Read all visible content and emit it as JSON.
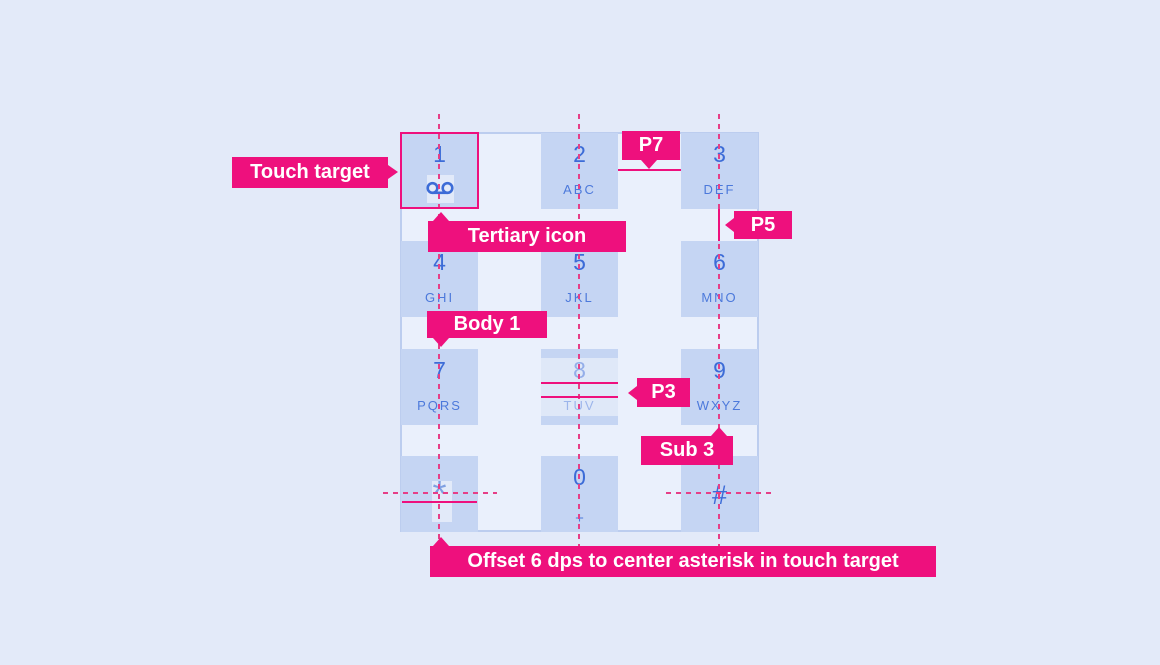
{
  "colors": {
    "page_background": "#E3EAF9",
    "panel_background": "#EAF0FC",
    "panel_border": "#BCCDEF",
    "key_fill": "#C5D5F3",
    "digit_blue": "#3C6CD7",
    "letters_blue": "#4C79DB",
    "faded_blue": "#7FA0E2",
    "annotation_pink": "#EE107D",
    "guide_pink": "#E63E87"
  },
  "keypad": {
    "keys": [
      {
        "digit": "1",
        "sub": "",
        "icon": "voicemail-icon"
      },
      {
        "digit": "2",
        "sub": "ABC"
      },
      {
        "digit": "3",
        "sub": "DEF"
      },
      {
        "digit": "4",
        "sub": "GHI"
      },
      {
        "digit": "5",
        "sub": "JKL"
      },
      {
        "digit": "6",
        "sub": "MNO"
      },
      {
        "digit": "7",
        "sub": "PQRS"
      },
      {
        "digit": "8",
        "sub": "TUV",
        "state": "highlighted"
      },
      {
        "digit": "9",
        "sub": "WXYZ"
      },
      {
        "digit": "*",
        "sub": ""
      },
      {
        "digit": "0",
        "sub": "+"
      },
      {
        "digit": "#",
        "sub": ""
      }
    ]
  },
  "annotations": {
    "touch_target": "Touch target",
    "tertiary_icon": "Tertiary icon",
    "p7": "P7",
    "p5": "P5",
    "body1": "Body 1",
    "p3": "P3",
    "sub3": "Sub 3",
    "offset_note": "Offset 6 dps to center asterisk in touch target"
  }
}
